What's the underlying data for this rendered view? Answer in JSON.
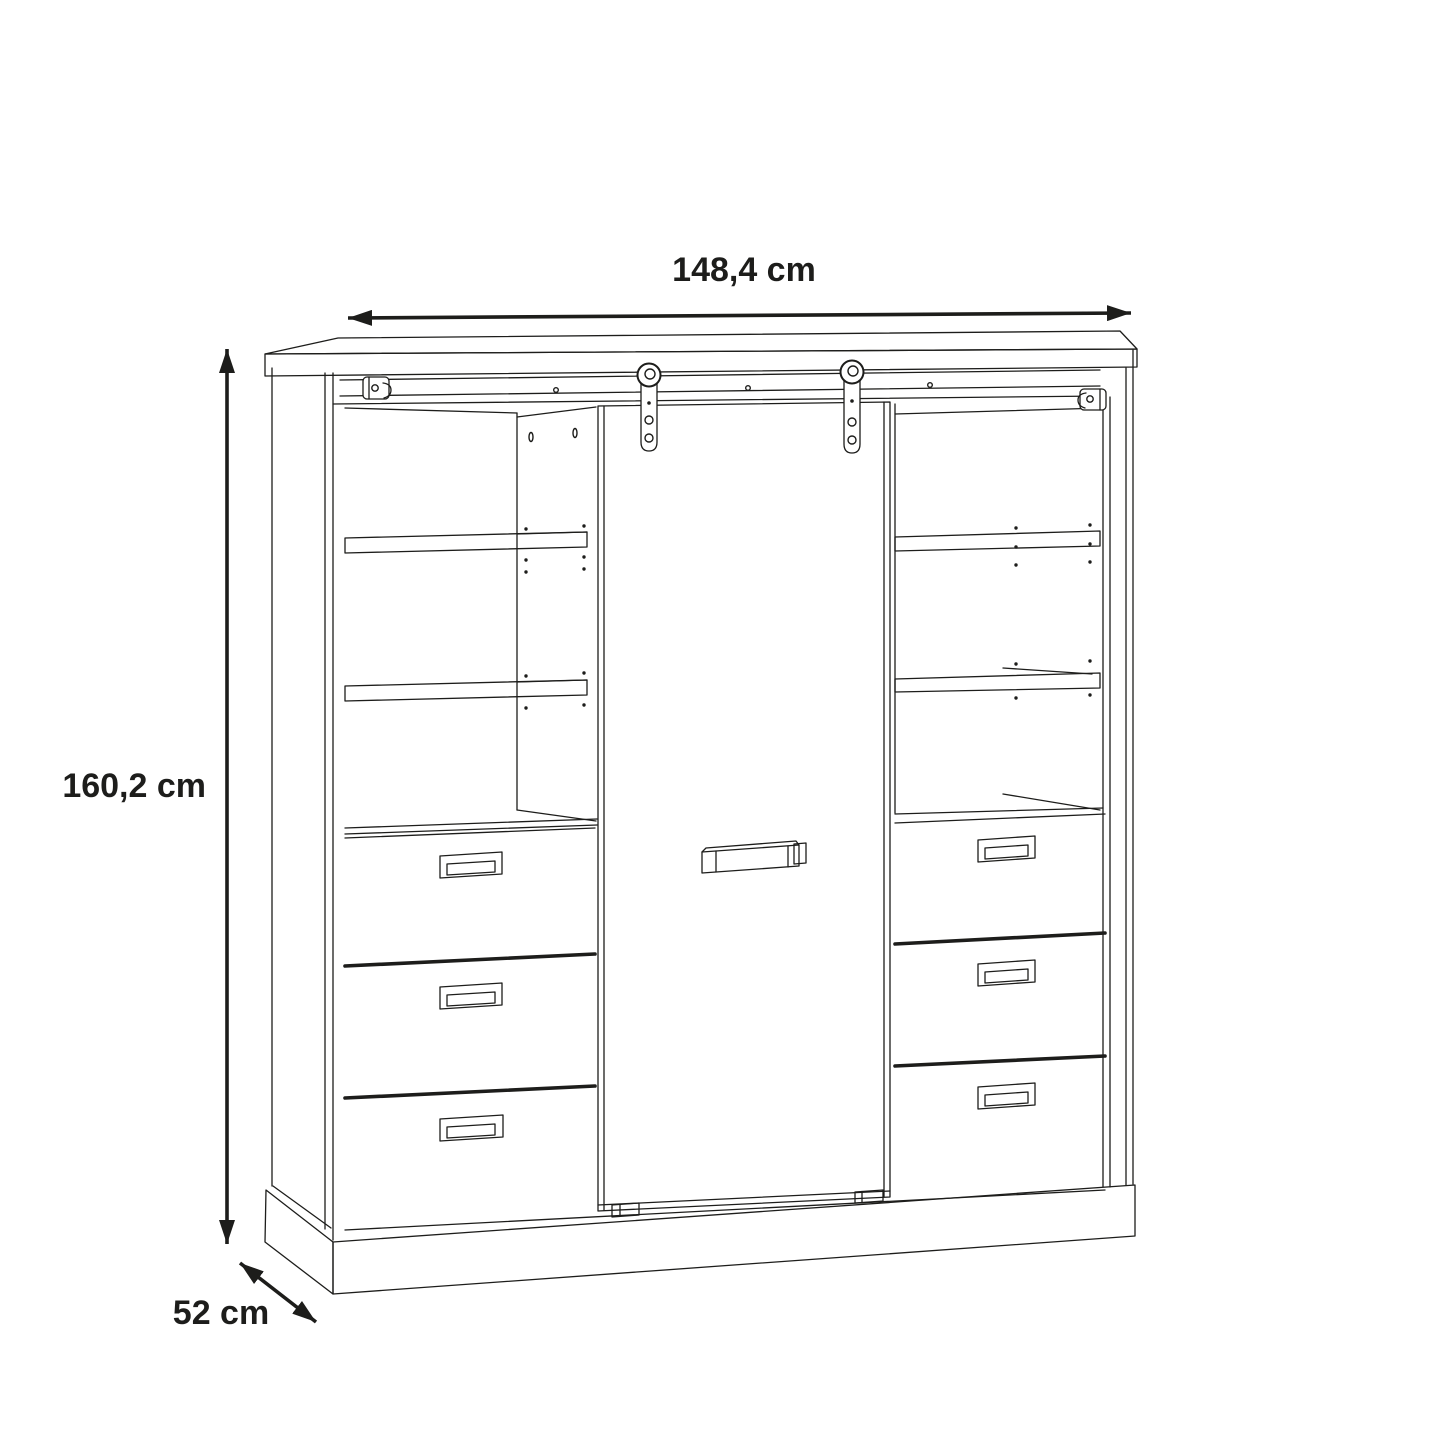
{
  "page": {
    "background": "#ffffff",
    "line_color": "#1d1d1b"
  },
  "drawing": {
    "kind": "wardrobe-dimension-diagram",
    "labels": {
      "width": "148,4 cm",
      "height": "160,2 cm",
      "depth": "52 cm"
    }
  }
}
